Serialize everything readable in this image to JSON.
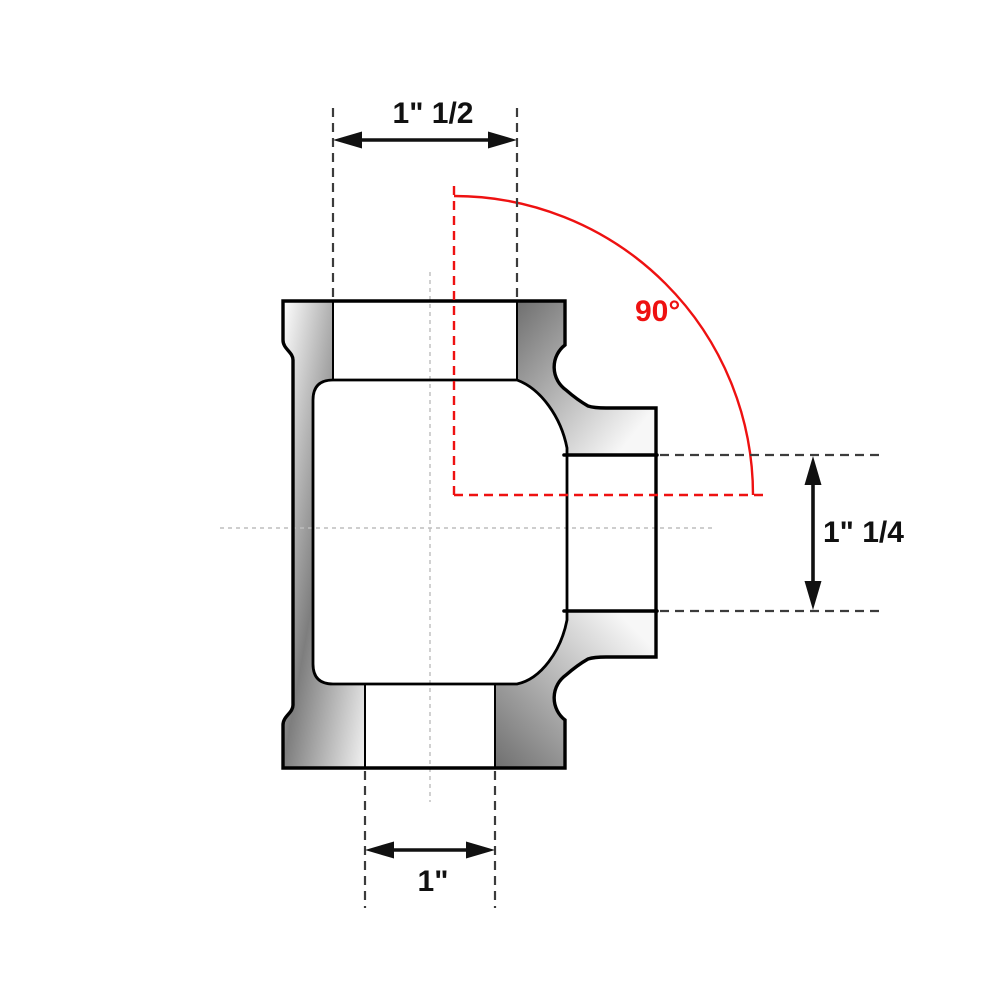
{
  "diagram": {
    "dimensions": {
      "top_width": "1\" 1/2",
      "branch_height": "1\" 1/4",
      "bottom_width": "1\"",
      "angle": "90°"
    },
    "colors": {
      "accent_red": "#ee1111",
      "line_black": "#000000",
      "extension_dash_gray": "#3c3c3c",
      "centerline_gray": "#bdbdbd"
    }
  }
}
